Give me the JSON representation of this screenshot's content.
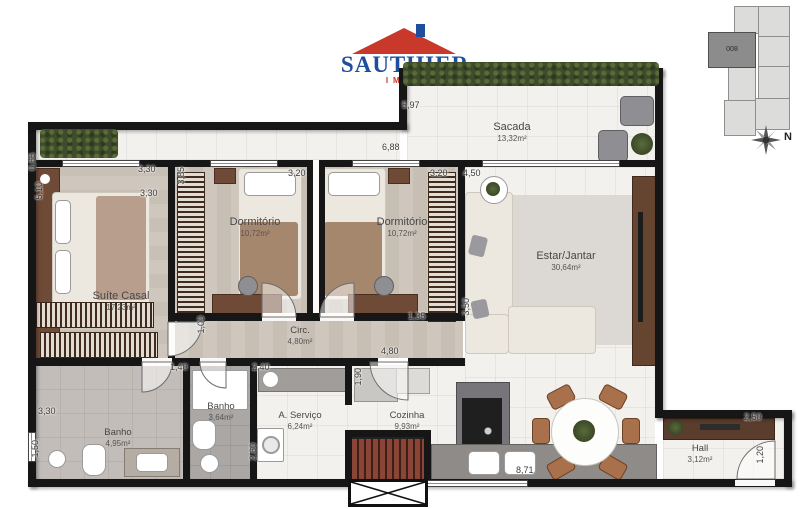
{
  "logo": {
    "brand": "SAUTHIER",
    "tagline": "IMÓVEIS"
  },
  "keyplan": {
    "unit": "008",
    "north": "N"
  },
  "rooms": {
    "sacada": {
      "name": "Sacada",
      "area": "13,32m²"
    },
    "suite": {
      "name": "Suíte Casal",
      "area": "17,23m²"
    },
    "dorm1": {
      "name": "Dormitório",
      "area": "10,72m²"
    },
    "dorm2": {
      "name": "Dormitório",
      "area": "10,72m²"
    },
    "estar": {
      "name": "Estar/Jantar",
      "area": "30,64m²"
    },
    "circ": {
      "name": "Circ.",
      "area": "4,80m²"
    },
    "banho_suite": {
      "name": "Banho",
      "area": "4,95m²"
    },
    "banho_social": {
      "name": "Banho",
      "area": "3,64m²"
    },
    "servico": {
      "name": "A. Serviço",
      "area": "6,24m²"
    },
    "cozinha": {
      "name": "Cozinha",
      "area": "9,93m²"
    },
    "hall": {
      "name": "Hall",
      "area": "3,12m²"
    }
  },
  "dims": {
    "d597": "5,97",
    "d688": "6,88",
    "d065": "0,65",
    "d510": "5,10",
    "d330a": "3,30",
    "d330b": "3,30",
    "d385": "3,85",
    "d320a": "3,20",
    "d320b": "3,20",
    "d450": "4,50",
    "d100": "1,00",
    "d135": "1,35",
    "d350": "3,50",
    "d480": "4,80",
    "d140": "1,40",
    "d240": "2,40",
    "d190": "1,90",
    "d260": "2,60",
    "d330c": "3,30",
    "d150": "1,50",
    "d871": "8,71",
    "d250": "2,50",
    "d120": "1,20"
  },
  "colors": {
    "brand_blue": "#1d4f9c",
    "brand_red": "#c8392b",
    "wall": "#161616",
    "hedge_green": "#3f4c2b",
    "wood_floor": "#cdc5bc",
    "tile": "#f3f1ee",
    "furniture_wood": "#6f4a36",
    "counter_gray": "#8e8b88"
  }
}
